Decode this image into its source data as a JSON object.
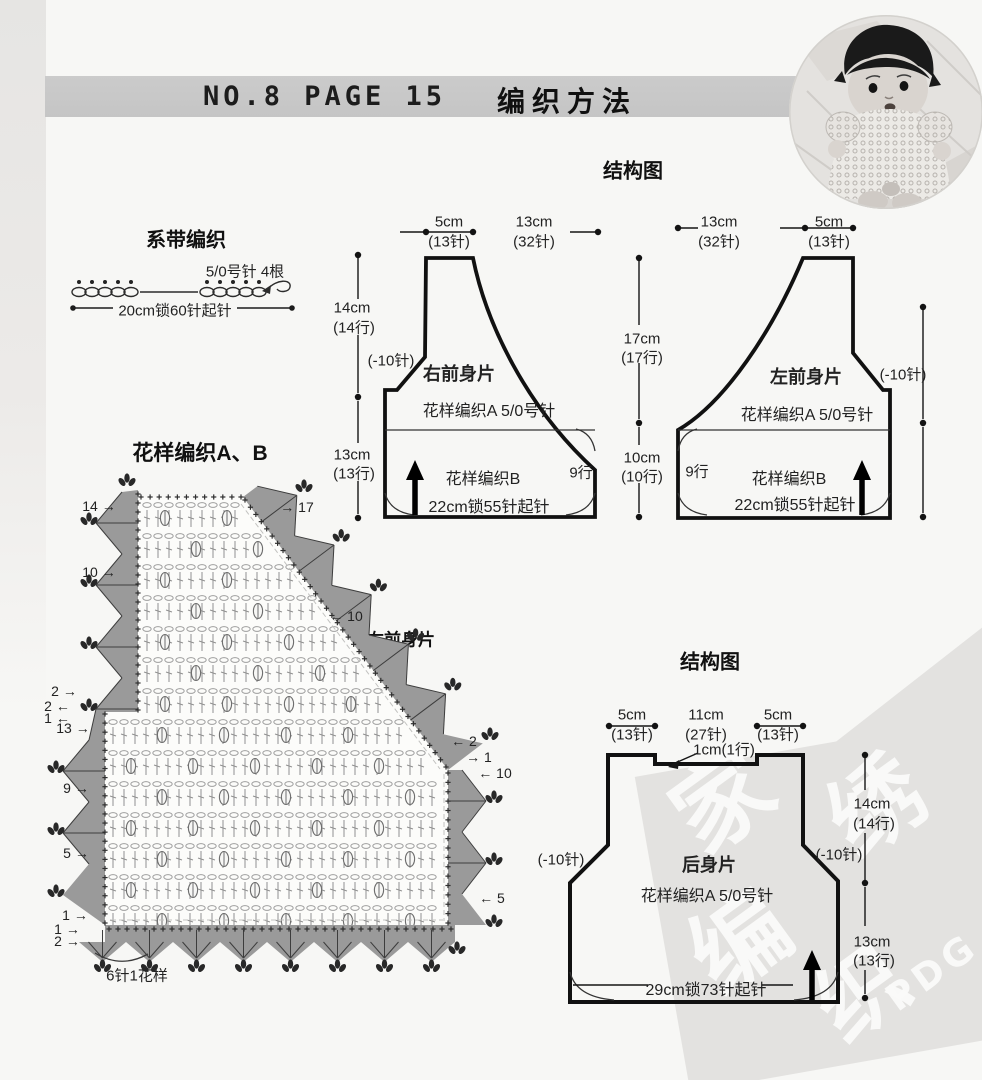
{
  "header": {
    "code": "NO.8 PAGE 15",
    "title": "编织方法"
  },
  "photo": {
    "alt": "baby-wearing-crochet-top"
  },
  "tie_section": {
    "title": "系带编织",
    "needle": "5/0号针  4根",
    "cast_on": "20cm锁60针起针"
  },
  "top_diagram": {
    "title": "结构图",
    "labels": [
      {
        "t": "5cm",
        "x": 449,
        "y": 222
      },
      {
        "t": "(13针)",
        "x": 449,
        "y": 241
      },
      {
        "t": "13cm",
        "x": 534,
        "y": 222
      },
      {
        "t": "(32针)",
        "x": 534,
        "y": 241
      },
      {
        "t": "14cm",
        "x": 352,
        "y": 308
      },
      {
        "t": "(14行)",
        "x": 354,
        "y": 327
      },
      {
        "t": "(-10针)",
        "x": 391,
        "y": 360
      },
      {
        "t": "右前身片",
        "x": 459,
        "y": 373,
        "b": 1,
        "s": 18,
        "n": "piece-name-right-front"
      },
      {
        "t": "花样编织A 5/0号针",
        "x": 489,
        "y": 409,
        "s": 16
      },
      {
        "t": "13cm",
        "x": 352,
        "y": 455
      },
      {
        "t": "(13行)",
        "x": 354,
        "y": 473
      },
      {
        "t": "花样编织B",
        "x": 483,
        "y": 477,
        "s": 16
      },
      {
        "t": "9行",
        "x": 581,
        "y": 472,
        "s": 15
      },
      {
        "t": "22cm锁55针起针",
        "x": 489,
        "y": 505,
        "s": 16
      },
      {
        "t": "17cm",
        "x": 642,
        "y": 339
      },
      {
        "t": "(17行)",
        "x": 642,
        "y": 357
      },
      {
        "t": "10cm",
        "x": 642,
        "y": 458
      },
      {
        "t": "(10行)",
        "x": 642,
        "y": 476
      },
      {
        "t": "13cm",
        "x": 719,
        "y": 222
      },
      {
        "t": "(32针)",
        "x": 719,
        "y": 241
      },
      {
        "t": "5cm",
        "x": 829,
        "y": 222
      },
      {
        "t": "(13针)",
        "x": 829,
        "y": 241
      },
      {
        "t": "左前身片",
        "x": 806,
        "y": 376,
        "b": 1,
        "s": 18,
        "n": "piece-name-left-front"
      },
      {
        "t": "(-10针)",
        "x": 903,
        "y": 374
      },
      {
        "t": "花样编织A 5/0号针",
        "x": 807,
        "y": 413,
        "s": 16
      },
      {
        "t": "9行",
        "x": 697,
        "y": 471,
        "s": 15
      },
      {
        "t": "花样编织B",
        "x": 789,
        "y": 477,
        "s": 16
      },
      {
        "t": "22cm锁55针起针",
        "x": 795,
        "y": 503,
        "s": 16
      }
    ]
  },
  "chart_section": {
    "title": "花样编织A、B",
    "piece": "右前身片",
    "unit_note": "6针1花样",
    "row_marks": [
      {
        "t": "14 →",
        "x": 99,
        "y": 506
      },
      {
        "t": "→ 17",
        "x": 297,
        "y": 507
      },
      {
        "t": "10 →",
        "x": 99,
        "y": 572
      },
      {
        "t": "← 10",
        "x": 346,
        "y": 616
      },
      {
        "t": "2 →",
        "x": 64,
        "y": 691
      },
      {
        "t": "2 ←",
        "x": 57,
        "y": 706
      },
      {
        "t": "1 ←",
        "x": 57,
        "y": 718
      },
      {
        "t": "13 →",
        "x": 73,
        "y": 728
      },
      {
        "t": "← 2",
        "x": 464,
        "y": 741
      },
      {
        "t": "→ 1",
        "x": 479,
        "y": 757
      },
      {
        "t": "← 10",
        "x": 495,
        "y": 773
      },
      {
        "t": "9 →",
        "x": 76,
        "y": 788
      },
      {
        "t": "5 →",
        "x": 76,
        "y": 853
      },
      {
        "t": "← 5",
        "x": 492,
        "y": 898
      },
      {
        "t": "1 →",
        "x": 75,
        "y": 915
      },
      {
        "t": "1 →",
        "x": 67,
        "y": 929
      },
      {
        "t": "2 →",
        "x": 67,
        "y": 941
      }
    ]
  },
  "back_diagram": {
    "title": "结构图",
    "labels": [
      {
        "t": "5cm",
        "x": 632,
        "y": 715
      },
      {
        "t": "(13针)",
        "x": 632,
        "y": 734
      },
      {
        "t": "11cm",
        "x": 706,
        "y": 715
      },
      {
        "t": "(27针)",
        "x": 706,
        "y": 734
      },
      {
        "t": "5cm",
        "x": 778,
        "y": 715
      },
      {
        "t": "(13针)",
        "x": 778,
        "y": 734
      },
      {
        "t": "1cm(1行)",
        "x": 724,
        "y": 749
      },
      {
        "t": "14cm",
        "x": 872,
        "y": 804
      },
      {
        "t": "(14行)",
        "x": 874,
        "y": 823
      },
      {
        "t": "(-10针)",
        "x": 561,
        "y": 859
      },
      {
        "t": "(-10针)",
        "x": 839,
        "y": 854
      },
      {
        "t": "后身片",
        "x": 709,
        "y": 864,
        "b": 1,
        "s": 18,
        "n": "piece-name-back"
      },
      {
        "t": "花样编织A 5/0号针",
        "x": 707,
        "y": 894,
        "s": 16
      },
      {
        "t": "13cm",
        "x": 872,
        "y": 942
      },
      {
        "t": "(13行)",
        "x": 874,
        "y": 960
      },
      {
        "t": "29cm锁73针起针",
        "x": 706,
        "y": 988,
        "s": 16
      }
    ]
  },
  "watermark": {
    "glyphs": [
      "家",
      "绣",
      "编",
      "织"
    ],
    "pdg": "PDG"
  },
  "colors": {
    "band": "#c8c8c8",
    "edging": "#9a9a9a",
    "ink": "#1c1c1c",
    "watermark": "#e3e2e0"
  }
}
